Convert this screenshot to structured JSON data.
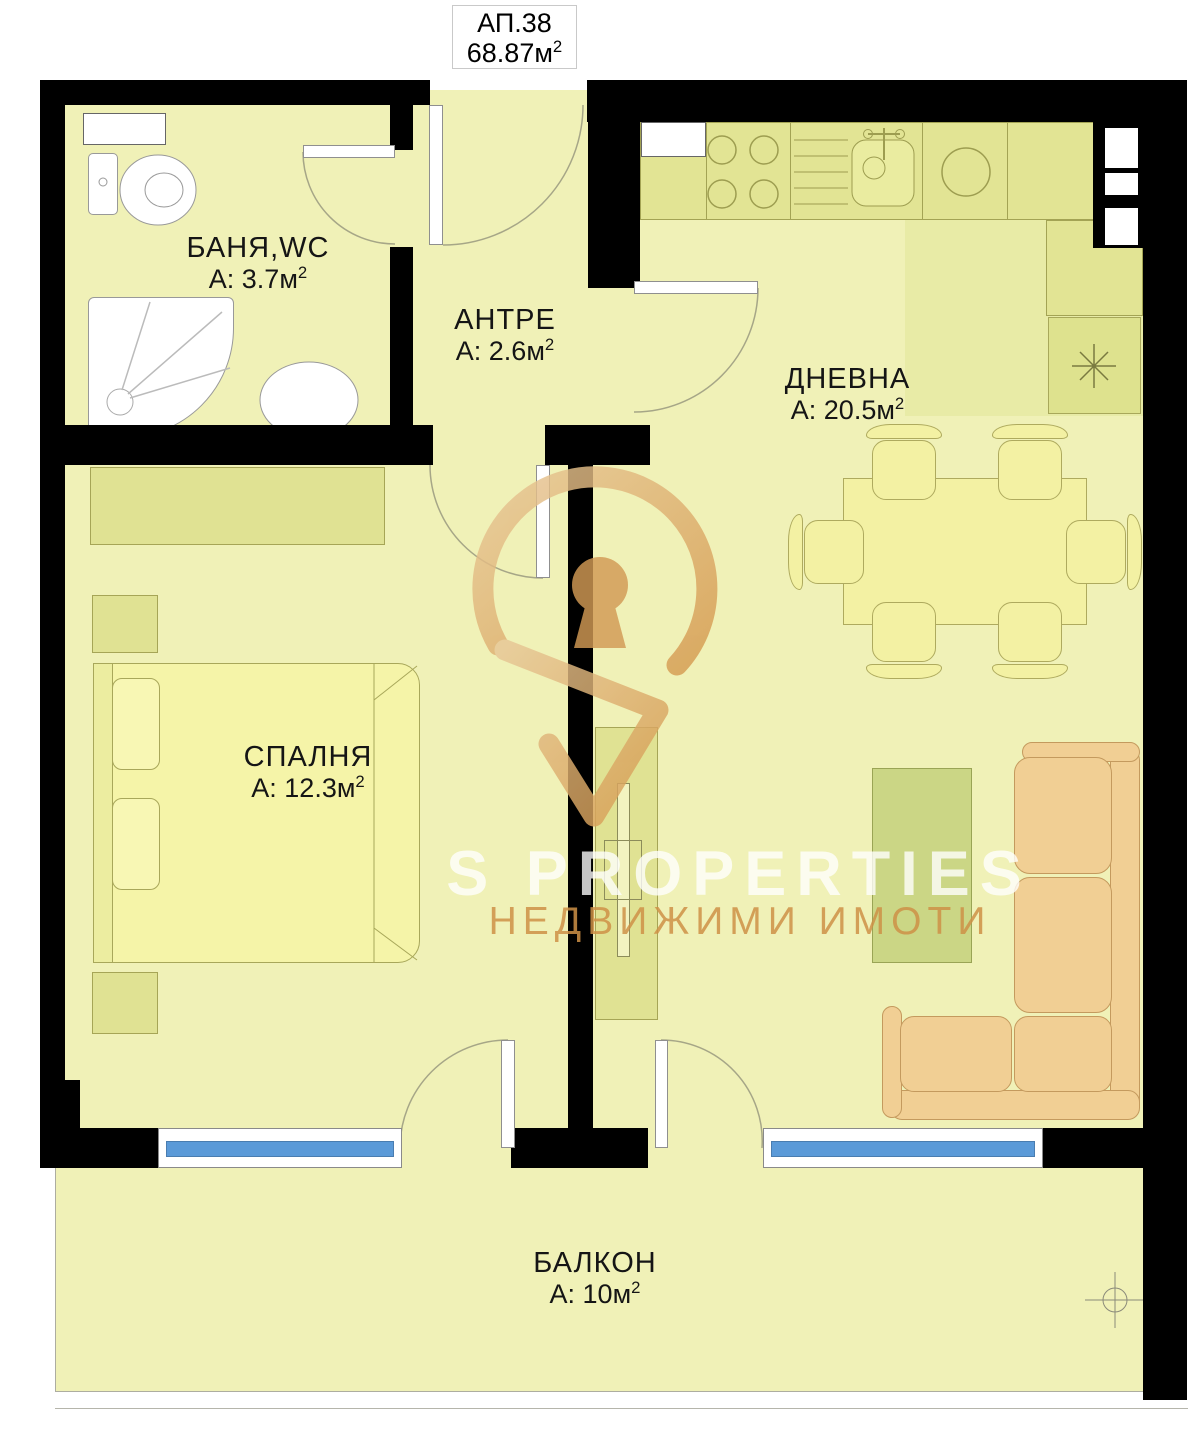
{
  "title": {
    "apartment": "АП.38",
    "area_prefix": "68.87м",
    "sup": "2"
  },
  "rooms": [
    {
      "id": "bathroom",
      "name": "БАНЯ,WC",
      "area_prefix": "А: 3.7м",
      "sup": "2"
    },
    {
      "id": "hallway",
      "name": "АНТРЕ",
      "area_prefix": "А: 2.6м",
      "sup": "2"
    },
    {
      "id": "living",
      "name": "ДНЕВНА",
      "area_prefix": "А: 20.5м",
      "sup": "2"
    },
    {
      "id": "bedroom",
      "name": "СПАЛНЯ",
      "area_prefix": "А: 12.3м",
      "sup": "2"
    },
    {
      "id": "balcony",
      "name": "БАЛКОН",
      "area_prefix": "А: 10м",
      "sup": "2"
    }
  ],
  "watermark": {
    "brand": "S PROPERTIES",
    "tagline": "НЕДВИЖИМИ ИМОТИ"
  },
  "colors": {
    "wall": "#000000",
    "floor": "#f0f1b7",
    "kitchen_floor": "#e8eba6",
    "furniture_khaki": "#e0e293",
    "sofa_tan": "#f1cf94",
    "window_blue": "#5b9ad8",
    "watermark_tan": "#d59a4f"
  }
}
